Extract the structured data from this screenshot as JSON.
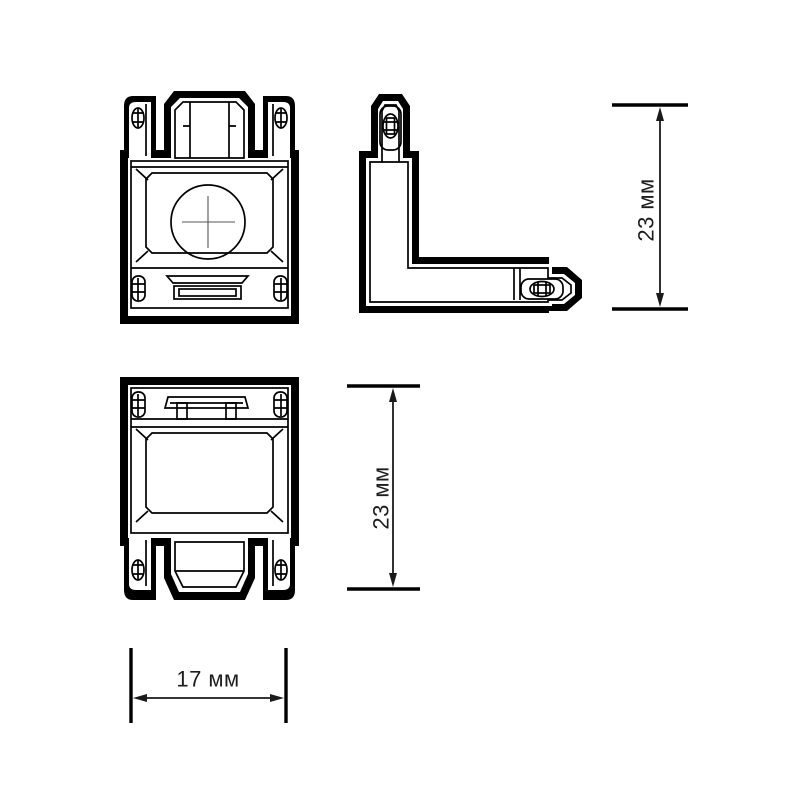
{
  "drawing": {
    "paper_color": "#ffffff",
    "ink_color": "#000000",
    "label_color": "#1c1c1c"
  },
  "icons": {
    "crosshair": "crosshair-icon",
    "screw_clip": "screw-clip-icon",
    "connector_socket": "connector-socket-icon",
    "latch": "latch-icon",
    "arrowhead": "arrowhead-icon"
  },
  "dimensions": {
    "corner_height": {
      "label": "23 мм",
      "value": 23,
      "unit": "мм"
    },
    "body_height": {
      "label": "23 мм",
      "value": 23,
      "unit": "мм"
    },
    "body_width": {
      "label": "17 мм",
      "value": 17,
      "unit": "мм"
    }
  }
}
